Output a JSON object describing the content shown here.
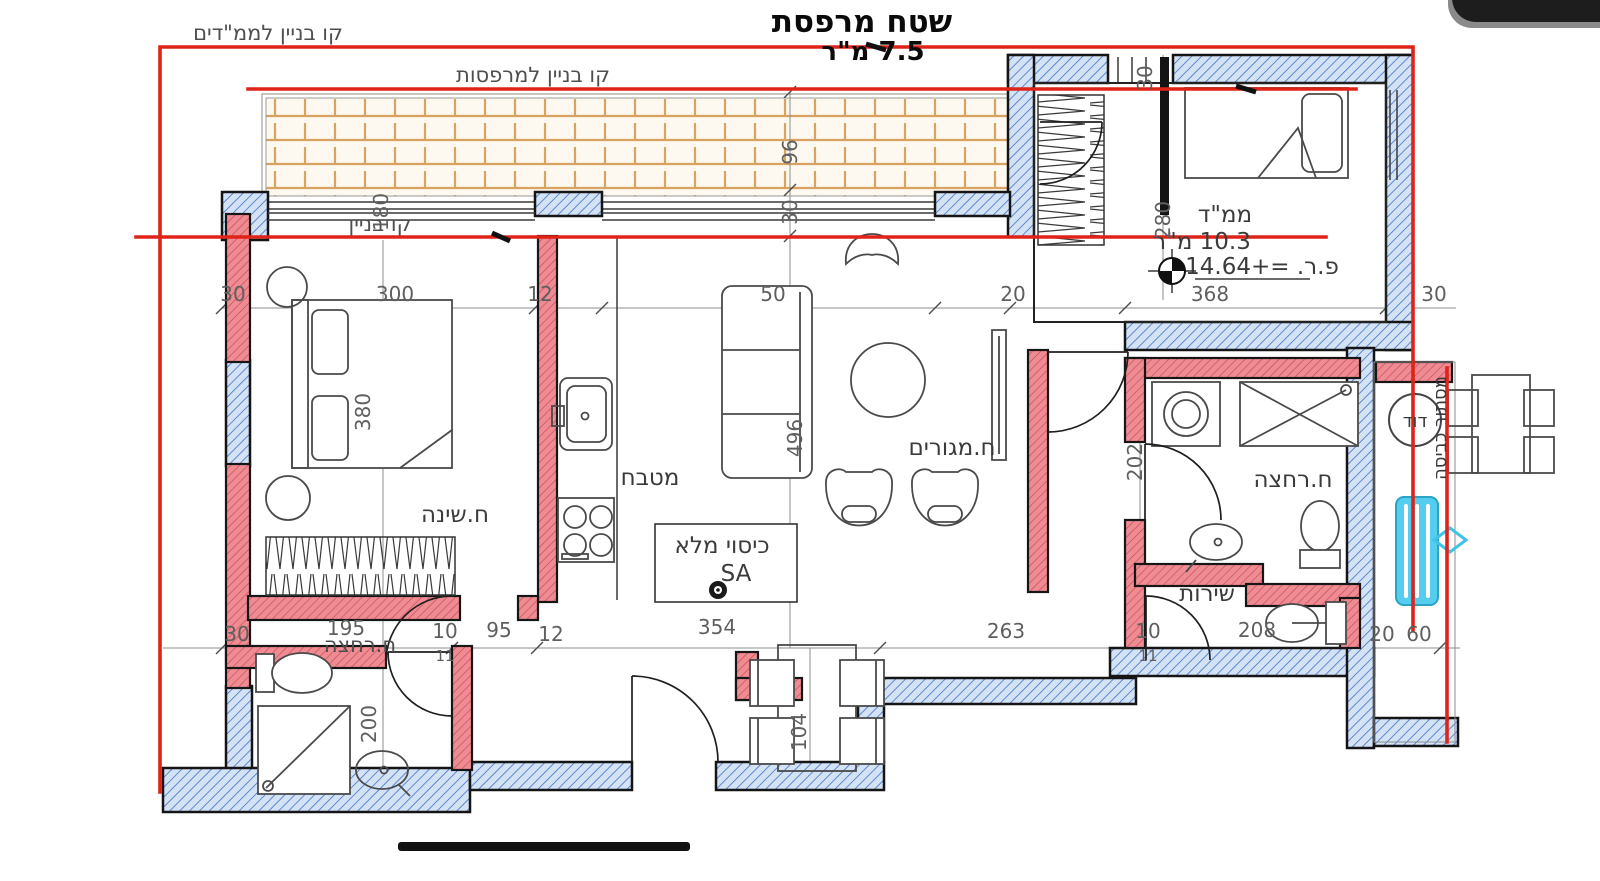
{
  "title": {
    "line1": "שטח מרפסת",
    "line2": "7.5 מ\"ר"
  },
  "building_lines": {
    "mamadim": "קו בניין לממ\"דים",
    "balconies": "קו בניין למרפסות",
    "building": "קו בניין"
  },
  "rooms": {
    "bedroom": "ח.שינה",
    "kitchen": "מטבח",
    "living": "ח.מגורים",
    "mamad": "ממ\"ד",
    "mamad_area": "10.3 מ\"ר",
    "mamad_level": "פ.ר. =+14.64",
    "bath": "ח.רחצה",
    "wc": "שירות",
    "bath2": "ח.רחצה",
    "boiler": "דוד",
    "laundry_screen": "מסתור כביסה"
  },
  "annotations": {
    "full_cover": "כיסוי מלא",
    "sa": "SA"
  },
  "dims": {
    "top_left_30": "30",
    "top_300": "300",
    "top_12": "12",
    "balcony_180": "180",
    "top_50": "50",
    "top_20": "20",
    "mamad_368": "368",
    "top_right_30": "30",
    "balcony_96": "96",
    "balcony_30": "30",
    "mamad_entry_30": "30",
    "mamad_280": "280",
    "bedroom_380": "380",
    "living_496": "496",
    "bath_202": "202",
    "bottom_30": "30",
    "bottom_195": "195",
    "bottom_10": "10",
    "bottom_11": "11",
    "bottom_95": "95",
    "bottom_12": "12",
    "bottom_354": "354",
    "bottom_263": "263",
    "wc_10": "10",
    "wc_11": "11",
    "wc_208": "208",
    "bottom_20": "20",
    "bottom_60": "60",
    "bath2_200": "200",
    "dining_104": "104"
  },
  "colors": {
    "line_red": "#df2318",
    "wall_blue_hatch": "#4a79c4",
    "wall_pink": "#ef8b93",
    "tile_orange": "#d9a35f",
    "ac_cyan": "#55cdee"
  }
}
